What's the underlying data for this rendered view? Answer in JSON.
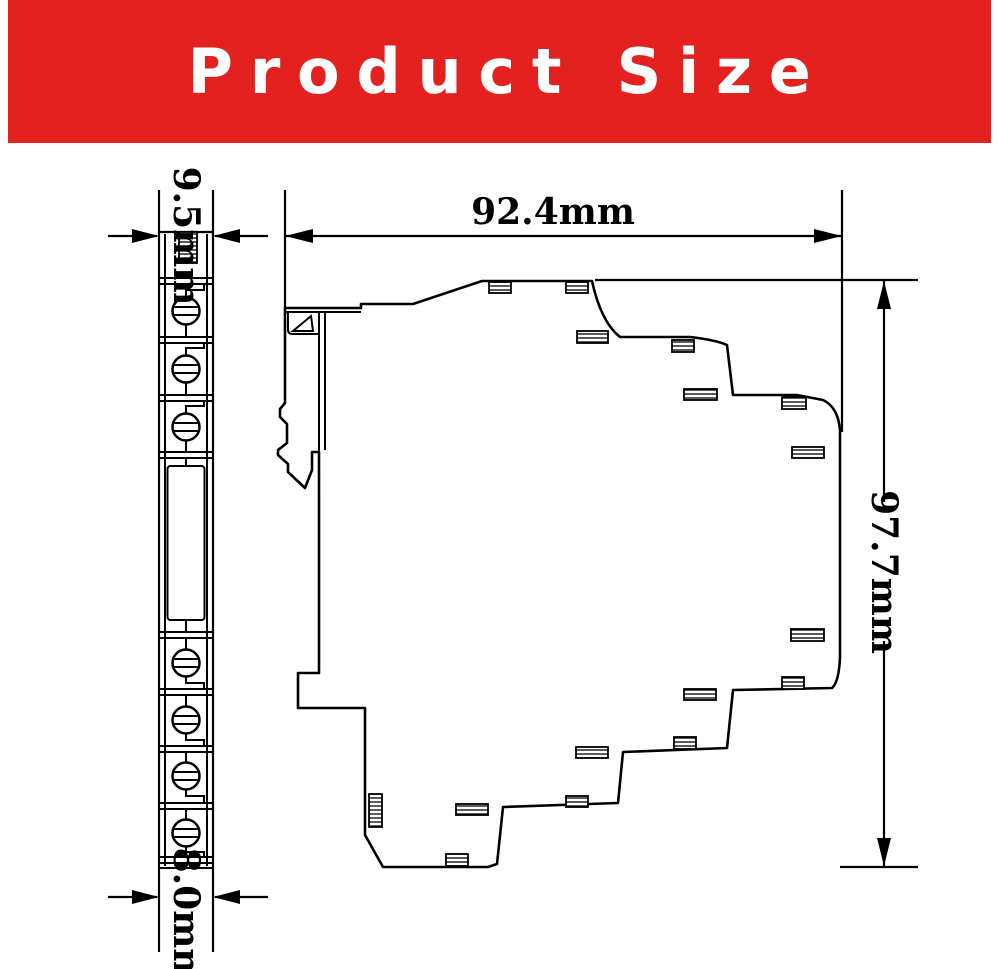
{
  "banner": {
    "title": "Product Size",
    "background_color": "#e3211f",
    "text_color": "#ffffff"
  },
  "drawing": {
    "line_color": "#000000",
    "background_color": "#ffffff",
    "dimensions": {
      "front_top_width": {
        "label": "9.5mm",
        "text_orientation": "vertical"
      },
      "side_depth": {
        "label": "92.4mm",
        "text_orientation": "horizontal"
      },
      "side_height": {
        "label": "97.7mm",
        "text_orientation": "vertical"
      },
      "front_bottom_width": {
        "label": "8.0mm",
        "text_orientation": "vertical"
      }
    }
  }
}
